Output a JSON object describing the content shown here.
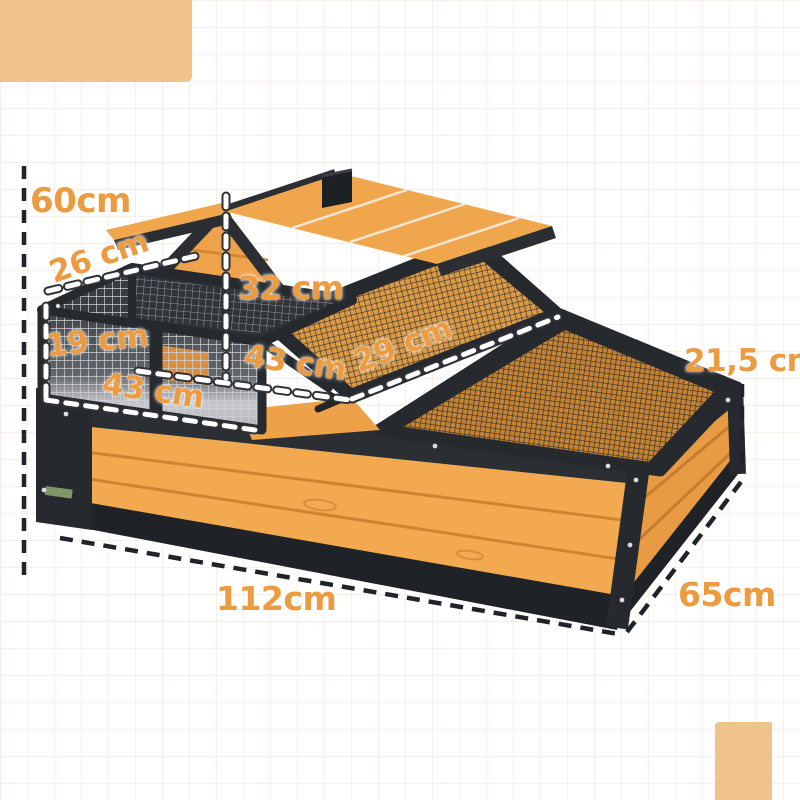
{
  "dimension_labels": [
    {
      "id": "total-height",
      "text": "60cm"
    },
    {
      "id": "balcony-depth",
      "text": "26 cm"
    },
    {
      "id": "house-height",
      "text": "32 cm"
    },
    {
      "id": "run-height",
      "text": "19 cm"
    },
    {
      "id": "middle-width",
      "text": "43 cm"
    },
    {
      "id": "run-width",
      "text": "43 cm"
    },
    {
      "id": "ramp-length",
      "text": "29 cm"
    },
    {
      "id": "wall-height",
      "text": "21,5 cm"
    },
    {
      "id": "total-length",
      "text": "112cm"
    },
    {
      "id": "total-depth",
      "text": "65cm"
    }
  ],
  "colors": {
    "label_orange": "#EC9B40",
    "wood_orange": "#F2A94F",
    "frame_black": "#2B2E33",
    "decor_corner": "#F0C28C",
    "dash_black": "#202329",
    "dash_white": "#FFFFFF"
  }
}
